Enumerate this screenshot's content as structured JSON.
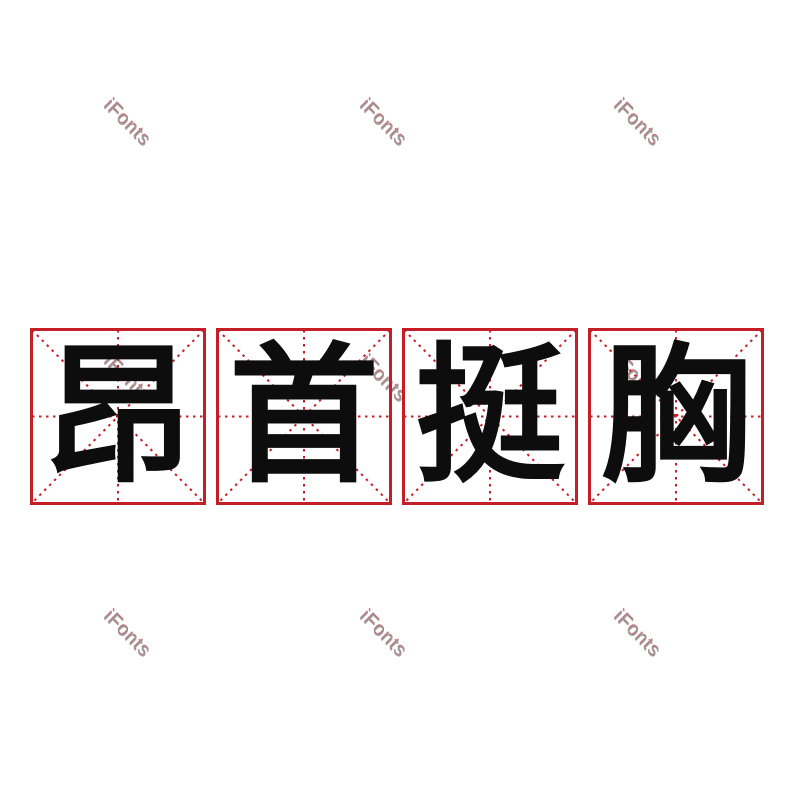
{
  "canvas": {
    "width": 800,
    "height": 800,
    "background": "#ffffff"
  },
  "phrase": {
    "full": "昂首挺胸",
    "characters": [
      "昂",
      "首",
      "挺",
      "胸"
    ]
  },
  "practice_grid": {
    "type": "mizige",
    "cells": 4,
    "frame_color": "#c41f26",
    "guide_line_color": "#c41f26",
    "character_color": "#0d0d0d"
  },
  "watermark": {
    "text": "iFonts",
    "color": "#8a8a8a",
    "dot_color": "#9e2128",
    "rotation_deg": 45,
    "count": 9
  }
}
